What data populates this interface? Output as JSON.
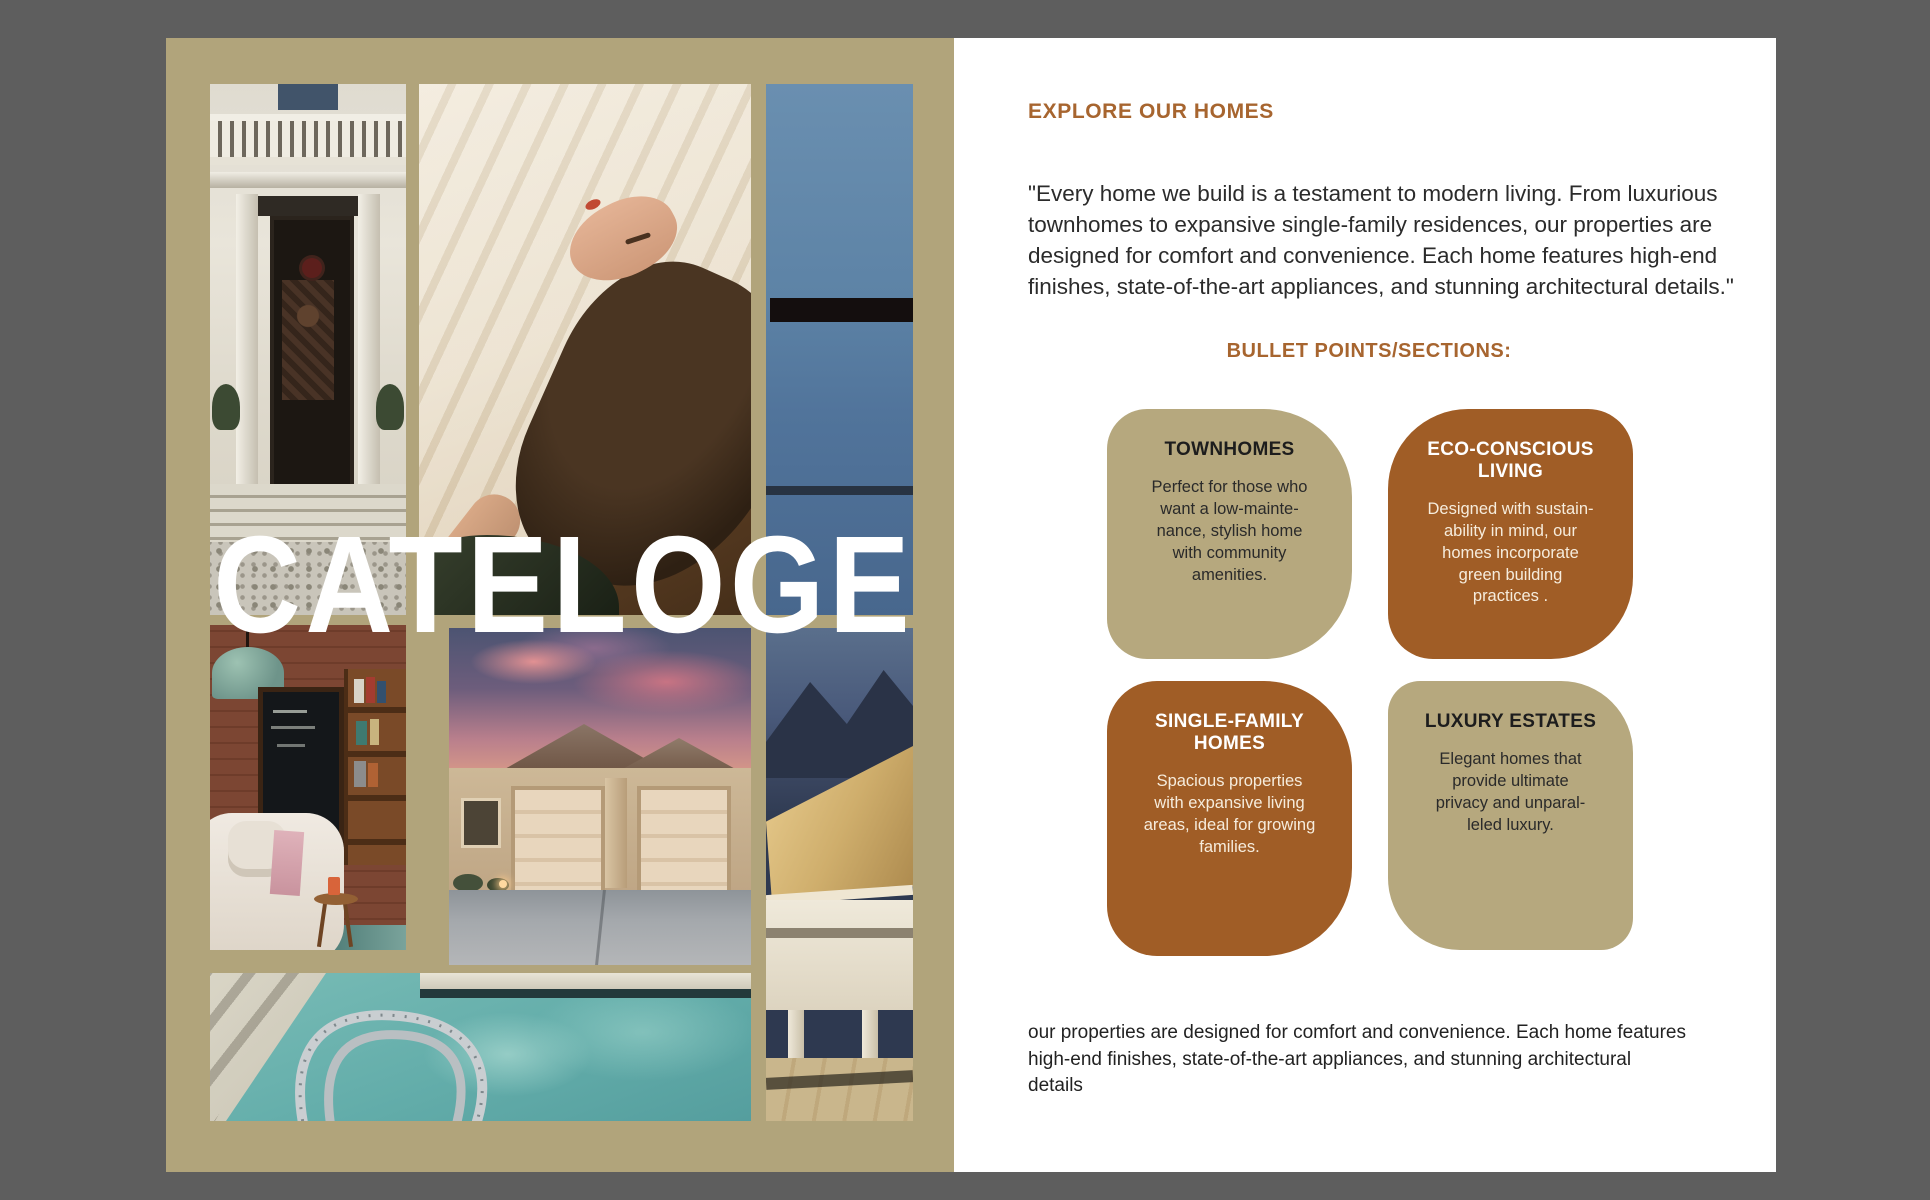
{
  "cover": {
    "title": "CATELOGE"
  },
  "right": {
    "heading": "EXPLORE OUR HOMES",
    "quote": "\"Every home we build is a testament to modern living. From luxurious\ntownhomes to expansive single-family residences, our properties are\ndesigned for comfort and convenience. Each home features high-end\nfinishes, state-of-the-art appliances, and stunning architectural details.\"",
    "bullets_heading": "BULLET POINTS/SECTIONS:",
    "cards": [
      {
        "id": "townhomes",
        "variant": "tan",
        "title": "TOWNHOMES",
        "body": "Perfect for those who\nwant a low-mainte-\nnance, stylish home\nwith community\namenities."
      },
      {
        "id": "eco-conscious-living",
        "variant": "brown",
        "title": "ECO-CONSCIOUS\nLIVING",
        "body": "Designed with sustain-\nability in mind, our\nhomes incorporate\ngreen building\npractices ."
      },
      {
        "id": "single-family-homes",
        "variant": "brown",
        "title": "SINGLE-FAMILY\nHOMES",
        "body": "Spacious properties\nwith expansive living\nareas, ideal for growing\nfamilies."
      },
      {
        "id": "luxury-estates",
        "variant": "tan",
        "title": "LUXURY ESTATES",
        "body": "Elegant homes that\nprovide ultimate\nprivacy and unparal-\nleled luxury."
      }
    ],
    "footer": "our properties are designed for comfort and convenience. Each home features\nhigh-end finishes, state-of-the-art appliances, and stunning architectural\ndetails"
  },
  "colors": {
    "backdrop_gray": "#5e5e5e",
    "cover_page_tan": "#b1a47b",
    "right_page_white": "#ffffff",
    "heading_brown": "#a7652f",
    "card_tan": "#b6a87e",
    "card_brown": "#a05d26",
    "cover_title_white": "#ffffff"
  }
}
